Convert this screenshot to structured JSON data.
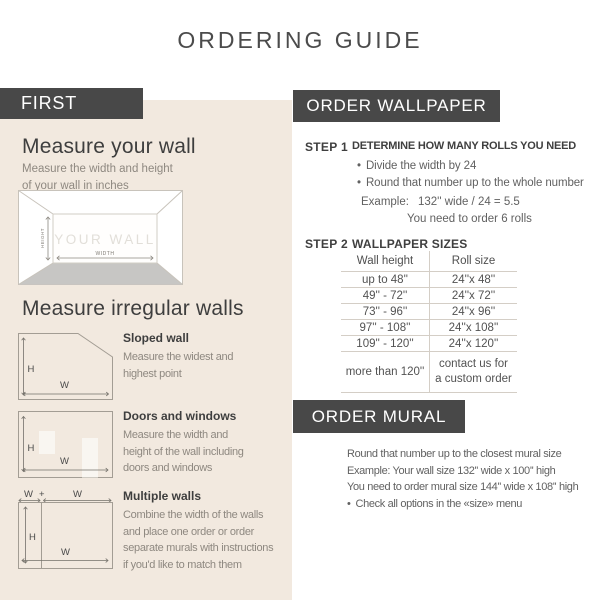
{
  "page": {
    "title": "ORDERING GUIDE"
  },
  "ui": {
    "bullet": "•"
  },
  "colors": {
    "badge_dark": "#484848",
    "panel_beige": "#f2e9df",
    "heading_dark": "#3e3e3e",
    "body_gray": "#8e8880",
    "table_line": "#d4cec6"
  },
  "labels": {
    "wall": "YOUR WALL",
    "height": "HEIGHT",
    "width": "WIDTH",
    "h": "H",
    "w": "W",
    "plus": "+"
  },
  "left_panel": {
    "badge": "FIRST",
    "measure_wall": {
      "heading": "Measure your wall",
      "subtext": "Measure the width and height\nof your wall in inches"
    },
    "irregular": {
      "heading": "Measure irregular walls",
      "items": [
        {
          "title": "Sloped wall",
          "description": "Measure the widest and\nhighest point"
        },
        {
          "title": "Doors and windows",
          "description": "Measure the width and\nheight of the wall including\ndoors and windows"
        },
        {
          "title": "Multiple walls",
          "description": "Combine the width of the walls\nand place one order or order\nseparate murals with instructions\nif you'd like to match them"
        }
      ]
    }
  },
  "wallpaper": {
    "badge": "ORDER WALLPAPER",
    "step1": {
      "label": "STEP 1",
      "heading": "DETERMINE HOW MANY ROLLS YOU NEED",
      "bullets": [
        "Divide the width by 24",
        "Round that number up to the whole number"
      ],
      "example_label": "Example:",
      "example_value": "132'' wide / 24 = 5.5",
      "example_result": "You need to order 6 rolls"
    },
    "step2": {
      "label": "STEP 2",
      "heading": "WALLPAPER SIZES",
      "table": {
        "headers": [
          "Wall height",
          "Roll size"
        ],
        "rows": [
          [
            "up to 48''",
            "24''x 48''"
          ],
          [
            "49'' - 72''",
            "24''x 72''"
          ],
          [
            "73'' - 96''",
            "24''x 96''"
          ],
          [
            "97'' - 108''",
            "24''x 108''"
          ],
          [
            "109'' - 120''",
            "24''x 120''"
          ],
          [
            "more than 120''",
            "contact us for\na custom order"
          ]
        ]
      }
    }
  },
  "mural": {
    "badge": "ORDER MURAL",
    "lines": [
      "Round that number up to the closest mural size",
      "Example: Your wall size 132'' wide x 100'' high",
      "You need to order mural size 144'' wide x 108'' high"
    ],
    "bullet": "Check all options in the «size» menu"
  }
}
